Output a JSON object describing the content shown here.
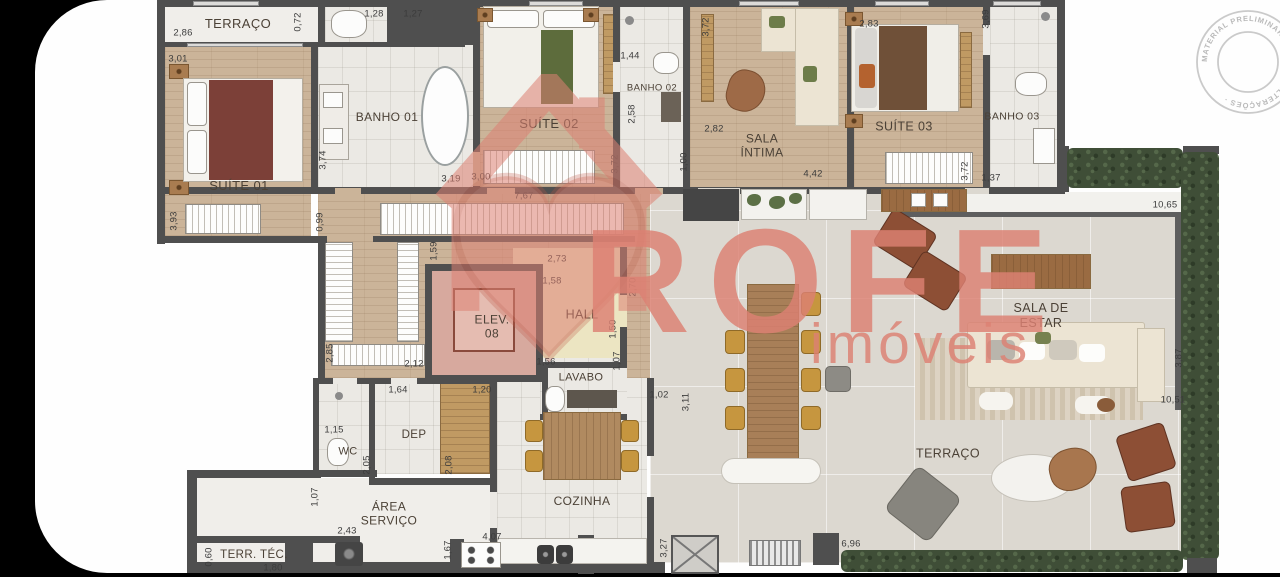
{
  "brand": {
    "name": "ROFE",
    "subtitle": "imóveis",
    "color": "#dd8173"
  },
  "stamp": {
    "text": "MATERIAL PRELIMINAR · SUJEITO ALTERAÇÕES ·",
    "color": "#b9b9b9"
  },
  "plan": {
    "wall_color": "#4f4f4f",
    "rooms": [
      {
        "id": "terraco-top",
        "label": "TERRAÇO",
        "x": 203,
        "y": 24,
        "fs": 13
      },
      {
        "id": "suite-01",
        "label": "SUÍTE 01",
        "x": 204,
        "y": 186,
        "fs": 13
      },
      {
        "id": "banho-01",
        "label": "BANHO 01",
        "x": 352,
        "y": 117,
        "fs": 12
      },
      {
        "id": "suite-02",
        "label": "SUÍTE 02",
        "x": 514,
        "y": 124,
        "fs": 13
      },
      {
        "id": "banho-02",
        "label": "BANHO 02",
        "x": 617,
        "y": 88,
        "fs": 9.5
      },
      {
        "id": "sala-intima",
        "label": "SALA\nÍNTIMA",
        "x": 727,
        "y": 146,
        "fs": 12
      },
      {
        "id": "suite-03",
        "label": "SUÍTE 03",
        "x": 869,
        "y": 127,
        "fs": 12.5
      },
      {
        "id": "banho-03",
        "label": "BANHO 03",
        "x": 977,
        "y": 117,
        "fs": 10.5
      },
      {
        "id": "elev-08",
        "label": "ELEV.\n08",
        "x": 457,
        "y": 327,
        "fs": 12
      },
      {
        "id": "hall",
        "label": "HALL",
        "x": 547,
        "y": 315,
        "fs": 12.5
      },
      {
        "id": "lavabo",
        "label": "LAVABO",
        "x": 546,
        "y": 378,
        "fs": 11
      },
      {
        "id": "wc",
        "label": "WC",
        "x": 313,
        "y": 452,
        "fs": 11
      },
      {
        "id": "dep",
        "label": "DEP",
        "x": 379,
        "y": 436,
        "fs": 11.5
      },
      {
        "id": "area-servico",
        "label": "ÁREA\nSERVIÇO",
        "x": 354,
        "y": 514,
        "fs": 12
      },
      {
        "id": "cozinha",
        "label": "COZINHA",
        "x": 547,
        "y": 501,
        "fs": 12
      },
      {
        "id": "terr-tec",
        "label": "TERR. TÉC.",
        "x": 219,
        "y": 556,
        "fs": 11.5
      },
      {
        "id": "sala-de-estar",
        "label": "SALA DE\nESTAR",
        "x": 1006,
        "y": 316,
        "fs": 12.5
      },
      {
        "id": "terraco-right",
        "label": "TERRAÇO",
        "x": 913,
        "y": 454,
        "fs": 12.5
      }
    ],
    "dimensions": [
      {
        "t": "2,86",
        "x": 148,
        "y": 33
      },
      {
        "t": "0,72",
        "x": 263,
        "y": 22,
        "r": 90
      },
      {
        "t": "1,28",
        "x": 339,
        "y": 14
      },
      {
        "t": "1,27",
        "x": 378,
        "y": 14
      },
      {
        "t": "3,01",
        "x": 143,
        "y": 59
      },
      {
        "t": "3,74",
        "x": 288,
        "y": 160,
        "r": 90
      },
      {
        "t": "3,19",
        "x": 416,
        "y": 179
      },
      {
        "t": "3,00",
        "x": 446,
        "y": 177
      },
      {
        "t": "3,93",
        "x": 139,
        "y": 221,
        "r": 90
      },
      {
        "t": "1,44",
        "x": 595,
        "y": 56
      },
      {
        "t": "2,58",
        "x": 597,
        "y": 114,
        "r": 90
      },
      {
        "t": "3,72",
        "x": 671,
        "y": 27,
        "r": 90
      },
      {
        "t": "2,82",
        "x": 679,
        "y": 129
      },
      {
        "t": "4,42",
        "x": 778,
        "y": 174
      },
      {
        "t": "1,00",
        "x": 649,
        "y": 162,
        "r": 90
      },
      {
        "t": "3,72",
        "x": 580,
        "y": 164,
        "r": 90
      },
      {
        "t": "2,83",
        "x": 834,
        "y": 24
      },
      {
        "t": "3,69",
        "x": 951,
        "y": 19,
        "r": 90
      },
      {
        "t": "1,37",
        "x": 956,
        "y": 178
      },
      {
        "t": "3,72",
        "x": 930,
        "y": 171,
        "r": 90
      },
      {
        "t": "10,65",
        "x": 1130,
        "y": 205
      },
      {
        "t": "7,67",
        "x": 489,
        "y": 196
      },
      {
        "t": "0,99",
        "x": 285,
        "y": 222,
        "r": 90
      },
      {
        "t": "1,59",
        "x": 399,
        "y": 251,
        "r": 90
      },
      {
        "t": "2,73",
        "x": 522,
        "y": 259
      },
      {
        "t": "1,58",
        "x": 517,
        "y": 281
      },
      {
        "t": "2,70",
        "x": 598,
        "y": 287,
        "r": 90
      },
      {
        "t": "1,50",
        "x": 578,
        "y": 329,
        "r": 90
      },
      {
        "t": "2,85",
        "x": 295,
        "y": 353,
        "r": 90
      },
      {
        "t": "2,12",
        "x": 379,
        "y": 364
      },
      {
        "t": "1,56",
        "x": 511,
        "y": 362
      },
      {
        "t": "1,07",
        "x": 582,
        "y": 361,
        "r": 90
      },
      {
        "t": "1,64",
        "x": 363,
        "y": 390
      },
      {
        "t": "1,20",
        "x": 447,
        "y": 390
      },
      {
        "t": "1,02",
        "x": 624,
        "y": 395
      },
      {
        "t": "1,15",
        "x": 299,
        "y": 430
      },
      {
        "t": "2,05",
        "x": 332,
        "y": 465,
        "r": 90
      },
      {
        "t": "2,08",
        "x": 414,
        "y": 465,
        "r": 90
      },
      {
        "t": "3,11",
        "x": 651,
        "y": 402,
        "r": 90
      },
      {
        "t": "1,07",
        "x": 280,
        "y": 497,
        "r": 90
      },
      {
        "t": "2,43",
        "x": 312,
        "y": 531
      },
      {
        "t": "4,07",
        "x": 457,
        "y": 537
      },
      {
        "t": "1,67",
        "x": 413,
        "y": 550,
        "r": 90
      },
      {
        "t": "0,60",
        "x": 174,
        "y": 557,
        "r": 90
      },
      {
        "t": "1,80",
        "x": 238,
        "y": 568
      },
      {
        "t": "3,27",
        "x": 629,
        "y": 548,
        "r": 90
      },
      {
        "t": "6,96",
        "x": 816,
        "y": 544
      },
      {
        "t": "3,87",
        "x": 1144,
        "y": 358,
        "r": 90
      },
      {
        "t": "10,51",
        "x": 1138,
        "y": 400
      }
    ]
  }
}
